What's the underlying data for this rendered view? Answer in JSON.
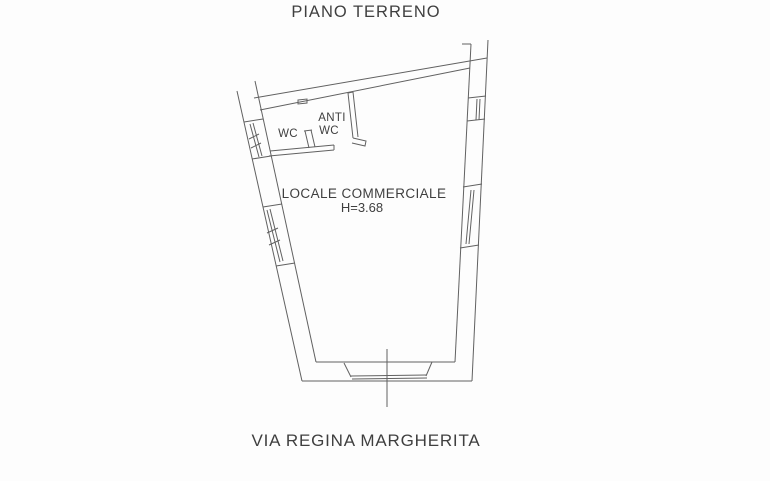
{
  "page": {
    "title": "PIANO TERRENO",
    "street_label": "VIA REGINA MARGHERITA"
  },
  "plan": {
    "room_label": "LOCALE COMMERCIALE",
    "room_height": "H=3.68",
    "wc_label": "WC",
    "anti_wc_line1": "ANTI",
    "anti_wc_line2": "WC"
  },
  "colors": {
    "paper": "#fdfdfd",
    "line": "#616161",
    "text": "#3f3f3f"
  }
}
